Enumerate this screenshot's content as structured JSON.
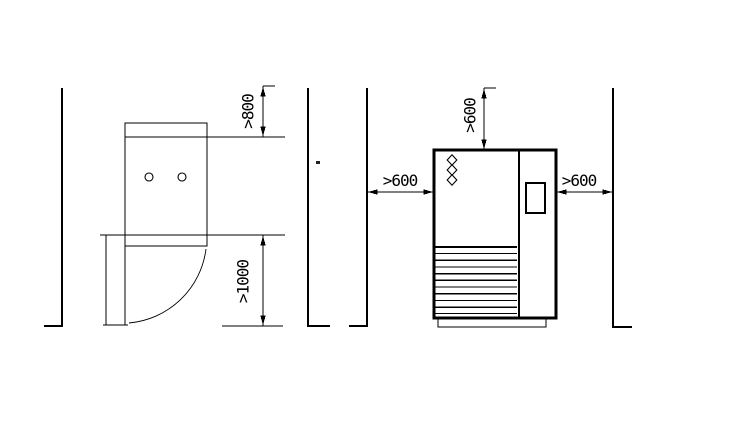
{
  "diagram": {
    "background_color": "#ffffff",
    "line_color": "#000000",
    "plan_view": {
      "description": "cabinet plan view with door swing arc",
      "front_clearance_label": ">800",
      "door_clearance_label": ">1000"
    },
    "front_view": {
      "description": "cabinet front view with louvered vent panel",
      "top_clearance_label": ">600",
      "left_clearance_label": ">600",
      "right_clearance_label": ">600"
    }
  }
}
